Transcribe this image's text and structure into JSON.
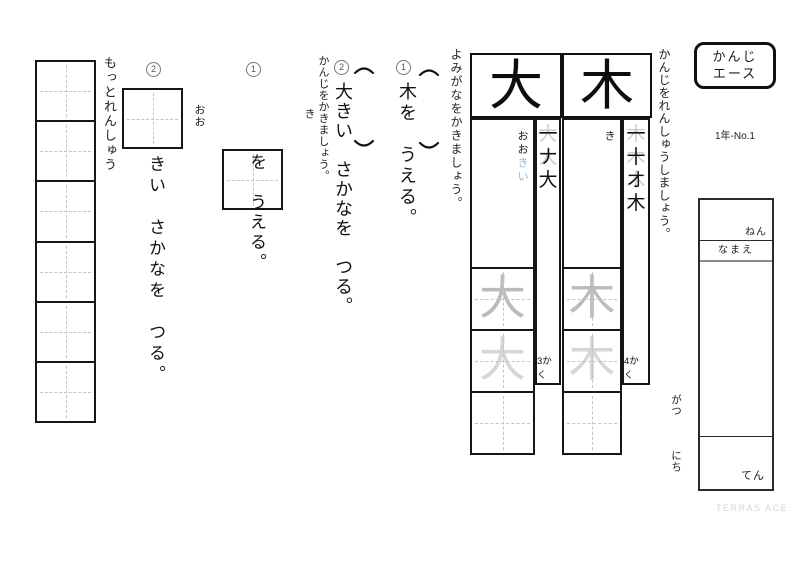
{
  "header": {
    "title_line1": "かんじ",
    "title_line2": "エース",
    "grade_no": "1年-No.1"
  },
  "labels": {
    "renshuu": "かんじをれんしゅうしましょう。",
    "yomigana": "よみがなをかきましょう。",
    "kanji_kaki": "かんじをかきましょう。",
    "motto": "もっとれんしゅう"
  },
  "name_box": {
    "nen": "ねん",
    "namae": "なまえ",
    "ten": "てん",
    "gatsu": "がつ",
    "nichi": "にち"
  },
  "kanji_cells": [
    {
      "kanji": "大",
      "reading_main": "おお",
      "reading_okuri": "きい",
      "stroke_count": "3かく",
      "strokes": [
        {
          "front": "一",
          "back": "大"
        },
        {
          "front": "ナ",
          "back": "大"
        },
        {
          "front": "大",
          "back": ""
        }
      ]
    },
    {
      "kanji": "木",
      "reading_main": "き",
      "reading_okuri": "",
      "stroke_count": "4かく",
      "strokes": [
        {
          "front": "一",
          "back": "木"
        },
        {
          "front": "十",
          "back": "木"
        },
        {
          "front": "オ",
          "back": "木"
        },
        {
          "front": "木",
          "back": ""
        }
      ]
    }
  ],
  "reading_items": [
    {
      "number": "1",
      "sentence": "木を　うえる。"
    },
    {
      "number": "2",
      "sentence": "大きい　さかなを　つる。"
    }
  ],
  "writing_items": [
    {
      "number": "1",
      "hint": "き",
      "sentence": "を　うえる。"
    },
    {
      "number": "2",
      "hint": "おお",
      "sentence": "きい　さかなを　つる。"
    }
  ],
  "footer": {
    "brand": "TERRAS ACE"
  },
  "colors": {
    "okurigana_blue": "#8fb8dc",
    "trace_gray_dark": "#bcbcbc",
    "trace_gray_light": "#d6d6d6",
    "line_black": "#161616"
  }
}
